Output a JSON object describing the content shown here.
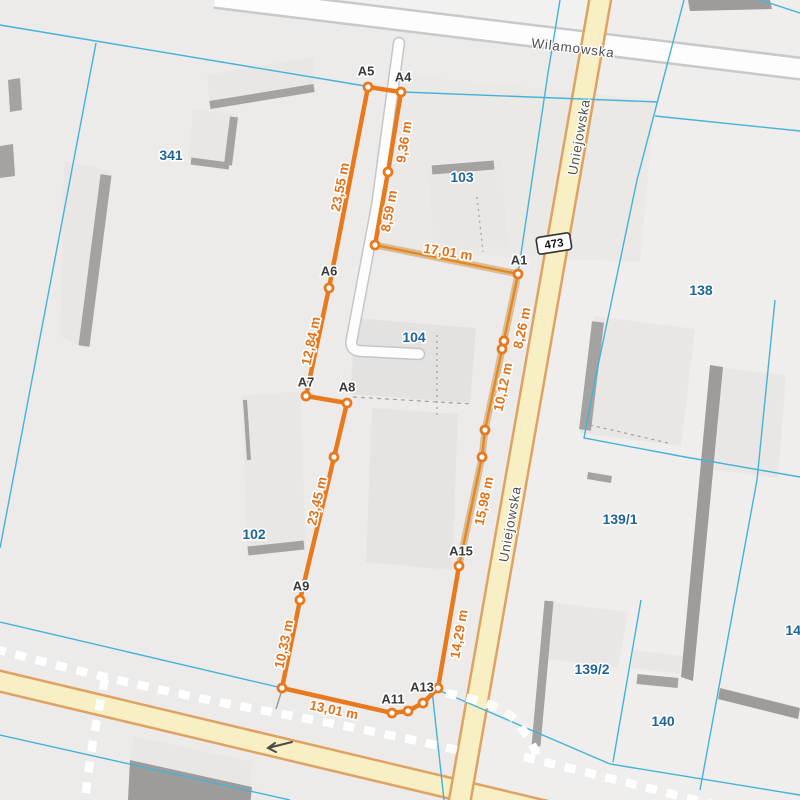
{
  "streets": [
    {
      "name": "Wilamowska"
    },
    {
      "name": "Uniejowska"
    },
    {
      "name": "Uniejowska"
    }
  ],
  "road_badge": {
    "number": "473"
  },
  "parcels": [
    {
      "number": "341"
    },
    {
      "number": "103"
    },
    {
      "number": "104"
    },
    {
      "number": "138"
    },
    {
      "number": "102"
    },
    {
      "number": "139/1"
    },
    {
      "number": "139/2"
    },
    {
      "number": "140"
    },
    {
      "number": "142"
    }
  ],
  "measurement": {
    "unit": "m",
    "points": [
      {
        "id": "A5"
      },
      {
        "id": "A4"
      },
      {
        "id": "A1"
      },
      {
        "id": "A6"
      },
      {
        "id": "A7"
      },
      {
        "id": "A8"
      },
      {
        "id": "A9"
      },
      {
        "id": "A11"
      },
      {
        "id": "A13"
      },
      {
        "id": "A15"
      }
    ],
    "segments": [
      {
        "length": "23,55 m"
      },
      {
        "length": "9,36 m"
      },
      {
        "length": "8,59 m"
      },
      {
        "length": "17,01 m"
      },
      {
        "length": "8,26 m"
      },
      {
        "length": "10,12 m"
      },
      {
        "length": "15,98 m"
      },
      {
        "length": "14,29 m"
      },
      {
        "length": "13,01 m"
      },
      {
        "length": "10,33 m"
      },
      {
        "length": "23,45 m"
      },
      {
        "length": "12,84 m"
      }
    ]
  },
  "colors": {
    "measurement_orange": "#e8791c",
    "boundary_cyan": "#45b2da",
    "parcel_label_blue": "#1d6598",
    "road_fill_yellow": "#f9efc4",
    "road_casing_yellow": "#e0a263",
    "street_label_gray": "#4f4f4f"
  }
}
